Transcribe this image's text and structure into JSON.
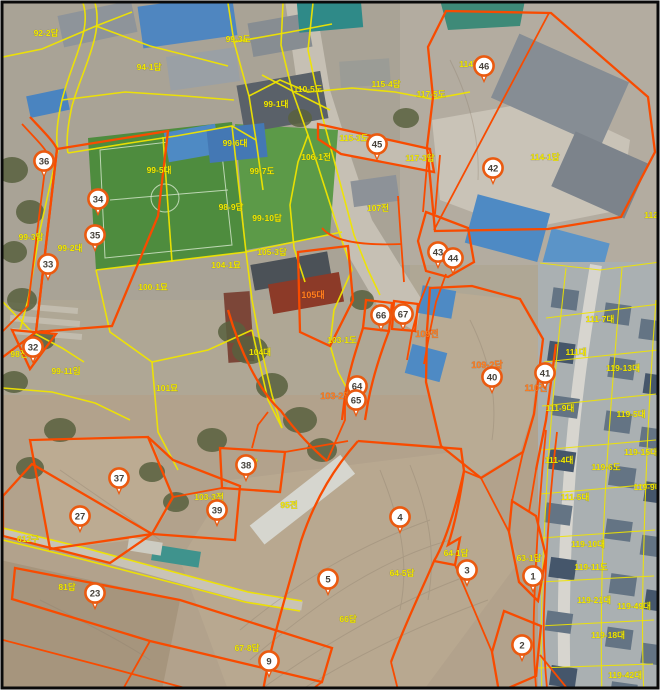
{
  "map": {
    "type": "aerial-cadastral-map",
    "colors": {
      "cadastral_line": "#efe400",
      "highlight_parcel_line": "#f84b00",
      "label_yellow": "#f2e800",
      "label_orange": "#ff7d1e",
      "marker_fill": "#ffffff",
      "marker_ring": "#ea5a10",
      "marker_number": "#46413a",
      "frame": "#0a0a0a",
      "margin": "#ffffff"
    },
    "labels": [
      {
        "t": "92-2답",
        "x": 46,
        "y": 36
      },
      {
        "t": "99-3도",
        "x": 238,
        "y": 42
      },
      {
        "t": "94-1답",
        "x": 149,
        "y": 70
      },
      {
        "t": "110-5도",
        "x": 308,
        "y": 92
      },
      {
        "t": "115-4답",
        "x": 386,
        "y": 87
      },
      {
        "t": "117-5도",
        "x": 431,
        "y": 97
      },
      {
        "t": "99-1대",
        "x": 276,
        "y": 107
      },
      {
        "t": "114답",
        "x": 470,
        "y": 67
      },
      {
        "t": "99-6대",
        "x": 235,
        "y": 146
      },
      {
        "t": "99-5대",
        "x": 159,
        "y": 173
      },
      {
        "t": "99-7도",
        "x": 262,
        "y": 174
      },
      {
        "t": "106-1전",
        "x": 316,
        "y": 160
      },
      {
        "t": "117-3답",
        "x": 420,
        "y": 161
      },
      {
        "t": "114-1답",
        "x": 545,
        "y": 160
      },
      {
        "t": "115-3도",
        "x": 354,
        "y": 141
      },
      {
        "t": "98-9답",
        "x": 231,
        "y": 210
      },
      {
        "t": "99-10답",
        "x": 267,
        "y": 221
      },
      {
        "t": "107전",
        "x": 378,
        "y": 211
      },
      {
        "t": "112전",
        "x": 655,
        "y": 218
      },
      {
        "t": "99-3답",
        "x": 31,
        "y": 240
      },
      {
        "t": "99-2대",
        "x": 70,
        "y": 251
      },
      {
        "t": "105-3답",
        "x": 272,
        "y": 255
      },
      {
        "t": "104-1묘",
        "x": 226,
        "y": 268
      },
      {
        "t": "100-1묘",
        "x": 153,
        "y": 290
      },
      {
        "t": "98전",
        "x": 19,
        "y": 357
      },
      {
        "t": "99-11임",
        "x": 66,
        "y": 374
      },
      {
        "t": "101묘",
        "x": 167,
        "y": 391
      },
      {
        "t": "103-1도",
        "x": 342,
        "y": 343
      },
      {
        "t": "104대",
        "x": 260,
        "y": 355
      },
      {
        "t": "105대",
        "x": 313,
        "y": 298,
        "c": "o"
      },
      {
        "t": "109전",
        "x": 427,
        "y": 337,
        "c": "o"
      },
      {
        "t": "109-2답",
        "x": 487,
        "y": 368,
        "c": "o"
      },
      {
        "t": "110전",
        "x": 536,
        "y": 391,
        "c": "o"
      },
      {
        "t": "103-2답",
        "x": 336,
        "y": 399,
        "c": "o"
      },
      {
        "t": "111-7대",
        "x": 600,
        "y": 322
      },
      {
        "t": "111대",
        "x": 576,
        "y": 355
      },
      {
        "t": "119-13대",
        "x": 623,
        "y": 371
      },
      {
        "t": "111-9대",
        "x": 560,
        "y": 411
      },
      {
        "t": "119-5대",
        "x": 631,
        "y": 417
      },
      {
        "t": "111-4대",
        "x": 559,
        "y": 463
      },
      {
        "t": "119-15대",
        "x": 641,
        "y": 455
      },
      {
        "t": "119-6도",
        "x": 606,
        "y": 470
      },
      {
        "t": "119-9대",
        "x": 648,
        "y": 490
      },
      {
        "t": "111-5대",
        "x": 575,
        "y": 500
      },
      {
        "t": "119-10대",
        "x": 588,
        "y": 547
      },
      {
        "t": "119-11도",
        "x": 591,
        "y": 570
      },
      {
        "t": "63-1답",
        "x": 529,
        "y": 561
      },
      {
        "t": "119-21대",
        "x": 594,
        "y": 603
      },
      {
        "t": "119-49대",
        "x": 634,
        "y": 609
      },
      {
        "t": "119-18대",
        "x": 608,
        "y": 638
      },
      {
        "t": "119-42대",
        "x": 625,
        "y": 678
      },
      {
        "t": "104답",
        "x": 247,
        "y": 466
      },
      {
        "t": "103-3전",
        "x": 209,
        "y": 500
      },
      {
        "t": "95전",
        "x": 289,
        "y": 508
      },
      {
        "t": "64-1답",
        "x": 456,
        "y": 556
      },
      {
        "t": "64-5답",
        "x": 402,
        "y": 576
      },
      {
        "t": "66답",
        "x": 348,
        "y": 622
      },
      {
        "t": "67-8답",
        "x": 247,
        "y": 651
      },
      {
        "t": "81답",
        "x": 67,
        "y": 590
      },
      {
        "t": "612구",
        "x": 28,
        "y": 542
      }
    ],
    "markers": [
      {
        "n": 36,
        "x": 44,
        "y": 161
      },
      {
        "n": 34,
        "x": 98,
        "y": 199
      },
      {
        "n": 35,
        "x": 95,
        "y": 235
      },
      {
        "n": 33,
        "x": 48,
        "y": 264
      },
      {
        "n": 32,
        "x": 33,
        "y": 347
      },
      {
        "n": 37,
        "x": 119,
        "y": 478
      },
      {
        "n": 27,
        "x": 80,
        "y": 516
      },
      {
        "n": 23,
        "x": 95,
        "y": 593
      },
      {
        "n": 39,
        "x": 217,
        "y": 510
      },
      {
        "n": 38,
        "x": 246,
        "y": 465
      },
      {
        "n": 9,
        "x": 269,
        "y": 661
      },
      {
        "n": 5,
        "x": 328,
        "y": 579
      },
      {
        "n": 4,
        "x": 400,
        "y": 517
      },
      {
        "n": 3,
        "x": 467,
        "y": 570
      },
      {
        "n": 1,
        "x": 533,
        "y": 576
      },
      {
        "n": 2,
        "x": 522,
        "y": 645
      },
      {
        "n": 64,
        "x": 357,
        "y": 386
      },
      {
        "n": 65,
        "x": 356,
        "y": 400
      },
      {
        "n": 66,
        "x": 381,
        "y": 315
      },
      {
        "n": 67,
        "x": 403,
        "y": 314
      },
      {
        "n": 43,
        "x": 438,
        "y": 252
      },
      {
        "n": 44,
        "x": 453,
        "y": 258
      },
      {
        "n": 45,
        "x": 377,
        "y": 144
      },
      {
        "n": 46,
        "x": 484,
        "y": 66
      },
      {
        "n": 42,
        "x": 493,
        "y": 168
      },
      {
        "n": 40,
        "x": 492,
        "y": 377
      },
      {
        "n": 41,
        "x": 545,
        "y": 373
      }
    ]
  }
}
